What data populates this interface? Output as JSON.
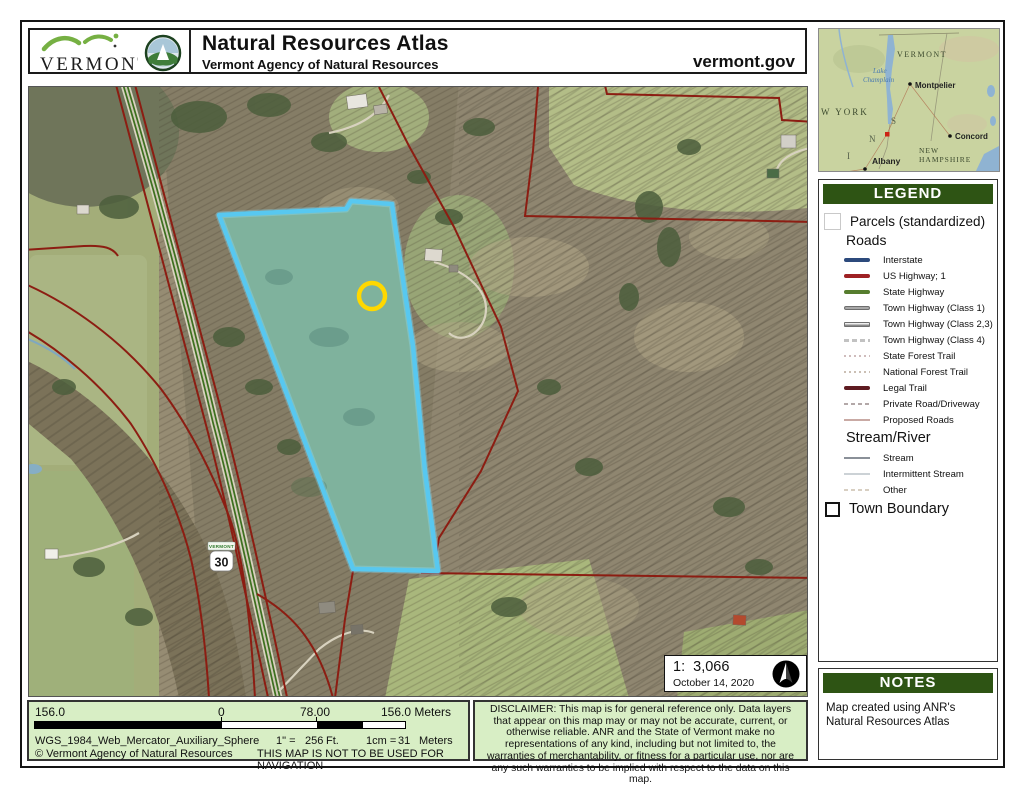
{
  "header": {
    "logo_text": "VERMONT",
    "title": "Natural Resources Atlas",
    "subtitle": "Vermont Agency of Natural Resources",
    "site": "vermont.gov"
  },
  "inset": {
    "state": "VERMONT",
    "lake_line1": "Lake",
    "lake_line2": "Champlain",
    "capital": "Montpelier",
    "region_left": "W YORK",
    "city_concord": "Concord",
    "nh_line1": "NEW",
    "nh_line2": "HAMPSHIRE",
    "city_albany": "Albany",
    "letters": [
      "S",
      "N",
      "I"
    ],
    "bottom_partial": "MASSACHUSETT"
  },
  "map": {
    "route_shield": "30",
    "route_state": "VERMONT",
    "scale_text": "1:  3,066",
    "date": "October 14, 2020"
  },
  "legend": {
    "title": "LEGEND",
    "parcels_label": "Parcels (standardized)",
    "roads_heading": "Roads",
    "road_items": [
      {
        "label": "Interstate",
        "color": "#2c4a7c"
      },
      {
        "label": "US Highway; 1",
        "color": "#9e2124"
      },
      {
        "label": "State Highway",
        "color": "#567d2e"
      },
      {
        "label": "Town Highway (Class 1)",
        "color": "#a8a8a8"
      },
      {
        "label": "Town Highway (Class 2,3)",
        "color": "#e8e8e8"
      },
      {
        "label": "Town Highway (Class 4)",
        "color": "#c2c2c2"
      },
      {
        "label": "State Forest Trail",
        "color": "#cfbcbc"
      },
      {
        "label": "National Forest Trail",
        "color": "#cbbfb4"
      },
      {
        "label": "Legal Trail",
        "color": "#5e1b21"
      },
      {
        "label": "Private Road/Driveway",
        "color": "#b3a8a8"
      },
      {
        "label": "Proposed Roads",
        "color": "#c9aaa4"
      }
    ],
    "stream_heading": "Stream/River",
    "stream_items": [
      {
        "label": "Stream",
        "color": "#8a9098"
      },
      {
        "label": "Intermittent Stream",
        "color": "#ccd2d6"
      },
      {
        "label": "Other",
        "color": "#d8cfc2"
      }
    ],
    "town_boundary_label": "Town Boundary"
  },
  "notes": {
    "title": "NOTES",
    "body": "Map created using ANR's Natural Resources Atlas"
  },
  "footer": {
    "bar_left": "156.0",
    "bar_zero": "0",
    "bar_mid": "78.00",
    "bar_right": "156.0 Meters",
    "projection": "WGS_1984_Web_Mercator_Auxiliary_Sphere",
    "copyright": "© Vermont Agency of Natural Resources",
    "inch_label": "1\" =",
    "inch_value": "256",
    "inch_unit": "Ft.",
    "cm_label": "1cm =",
    "cm_value": "31",
    "cm_unit": "Meters",
    "warning": "THIS MAP IS NOT TO BE USED FOR NAVIGATION",
    "disclaimer": "DISCLAIMER: This map is for general reference only. Data layers that appear on this map may or may not be accurate, current, or otherwise reliable. ANR and the State of Vermont make no representations of any kind, including but not limited to, the warranties of merchantability, or fitness for a particular use, nor are any such warranties to be implied with respect to the data on this map."
  },
  "colors": {
    "panel_green": "#2e5414",
    "footer_green": "#d8eec5",
    "parcel_red": "#8c1d12",
    "selection_cyan": "#58c8f0",
    "marker_yellow": "#ffd800",
    "state_highway_green": "#3e7020"
  }
}
